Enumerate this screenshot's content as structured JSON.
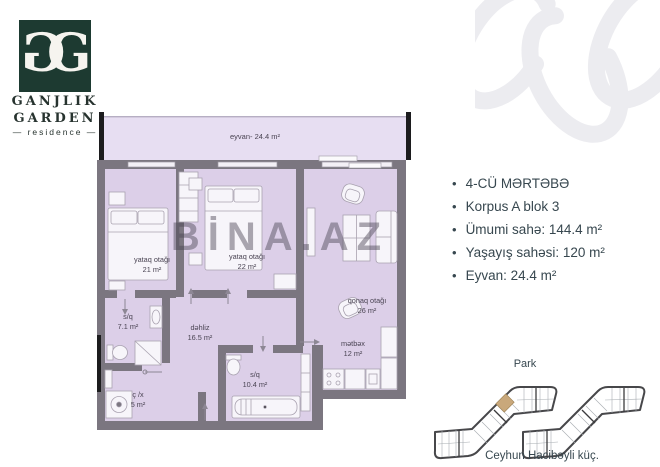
{
  "logo": {
    "monogram": "G",
    "line1": "GANJLIK",
    "line2": "GARDEN",
    "tagline": "— residence —"
  },
  "watermark": "BİNA.AZ",
  "details": {
    "items": [
      "4-CÜ MƏRTƏBƏ",
      "Korpus A blok 3",
      "Ümumi sahə: 144.4 m²",
      "Yaşayış sahəsi: 120 m²",
      "Eyvan: 24.4 m²"
    ]
  },
  "plan": {
    "balcony": {
      "label": "eyvan- 24.4 m²"
    },
    "rooms": {
      "bedroom1": {
        "name": "yataq otağı",
        "area": "21 m²"
      },
      "bedroom2": {
        "name": "yataq otağı",
        "area": "22 m²"
      },
      "living": {
        "name": "qonaq otağı",
        "area": "26 m²"
      },
      "bath1": {
        "name": "s/q",
        "area": "7.1 m²"
      },
      "hall": {
        "name": "dəhliz",
        "area": "16.5 m²"
      },
      "closet": {
        "name": "ç /x",
        "area": "5 m²"
      },
      "bath2": {
        "name": "s/q",
        "area": "10.4 m²"
      },
      "kitchen": {
        "name": "mətbəx",
        "area": "12 m²"
      }
    }
  },
  "site": {
    "park": "Park",
    "street": "Ceyhun Hacibəyli küç."
  },
  "colors": {
    "logo_green": "#1d3a31",
    "wall_gray": "#7b7680",
    "floor_lavender": "#dccfe8",
    "balcony_lavender": "#e7def2",
    "highlight_unit_tan": "#c9a87b",
    "text_dark": "#37474f"
  }
}
